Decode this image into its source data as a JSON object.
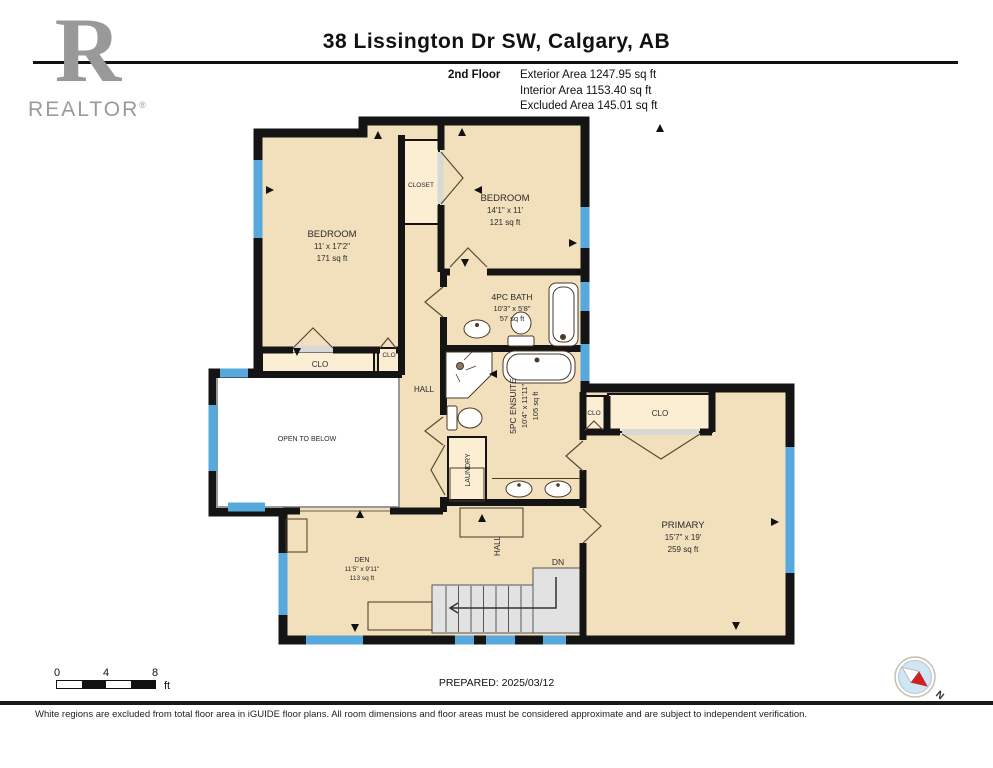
{
  "header": {
    "logo": {
      "letter": "R",
      "word": "REALTOR",
      "registered": "®"
    },
    "title": "38 Lissington Dr SW, Calgary, AB",
    "floor_label": "2nd Floor",
    "area_lines": {
      "exterior": "Exterior Area 1247.95 sq ft",
      "interior": "Interior Area 1153.40 sq ft",
      "excluded": "Excluded Area 145.01 sq ft"
    }
  },
  "plan": {
    "rooms": {
      "bedroom_left": {
        "name": "BEDROOM",
        "dims": "11' x 17'2\"",
        "area": "171 sq ft"
      },
      "bedroom_top": {
        "name": "BEDROOM",
        "dims": "14'1\" x 11'",
        "area": "121 sq ft"
      },
      "bath": {
        "name": "4PC BATH",
        "dims": "10'3\" x 5'8\"",
        "area": "57 sq ft"
      },
      "ensuite": {
        "name": "5PC ENSUITE",
        "dims": "10'4\" x 11'11\"",
        "area": "105 sq ft"
      },
      "primary": {
        "name": "PRIMARY",
        "dims": "15'7\" x 19'",
        "area": "259 sq ft"
      },
      "den": {
        "name": "DEN",
        "dims": "11'5\" x 9'11\"",
        "area": "113 sq ft"
      },
      "open_to_below": "OPEN TO BELOW",
      "closet": "CLOSET",
      "clo": "CLO",
      "hall": "HALL",
      "laundry": "LAUNDRY",
      "dn": "DN"
    },
    "colors": {
      "room_fill": "#f2dfbc",
      "closet_fill": "#fceed3",
      "wall": "#141414",
      "window": "#56a8dd",
      "stairs_fill": "#e2e2e2",
      "excluded_fill": "#ffffff"
    }
  },
  "footer": {
    "scale": {
      "tick0": "0",
      "tick4": "4",
      "tick8": "8",
      "unit": "ft"
    },
    "prepared": "PREPARED: 2025/03/12",
    "compass_label": "N",
    "disclaimer": "White regions are excluded from total floor area in iGUIDE floor plans. All room dimensions and floor areas must be considered approximate and are subject to independent verification."
  }
}
